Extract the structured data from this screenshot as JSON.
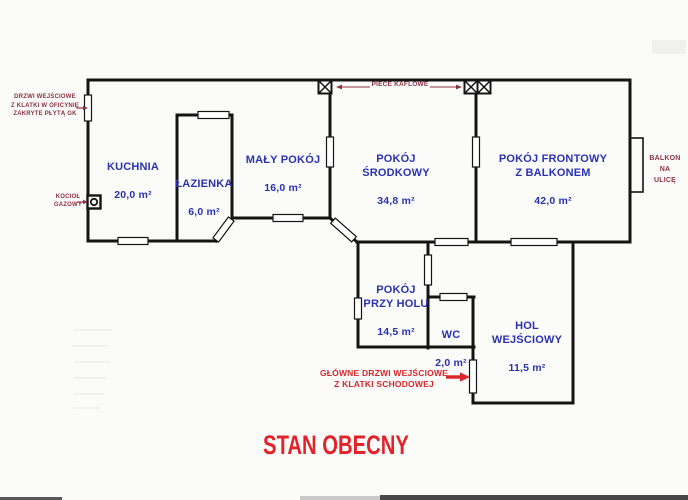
{
  "title": "STAN OBECNY",
  "colors": {
    "room_label_blue": "#2a33ae",
    "annotation_maroon": "#8b3342",
    "accent_red": "#d8272b",
    "title_red": "#e2242a",
    "wall_black": "#141414"
  },
  "plan": {
    "rooms": {
      "kuchnia": {
        "name": "KUCHNIA",
        "area": "20,0 m²"
      },
      "lazienka": {
        "name": "ŁAZIENKA",
        "area": "6,0 m²"
      },
      "maly_pokoj": {
        "name": "MAŁY POKÓJ",
        "area": "16,0 m²"
      },
      "pokoj_srodkowy": {
        "name": "POKÓJ\nŚRODKOWY",
        "area": "34,8 m²"
      },
      "pokoj_frontowy": {
        "name": "POKÓJ FRONTOWY\nZ BALKONEM",
        "area": "42,0 m²"
      },
      "pokoj_przy_holu": {
        "name": "POKÓJ\nPRZY HOLU",
        "area": "14,5 m²"
      },
      "wc": {
        "name": "WC",
        "area": "2,0 m²"
      },
      "hol_wejsciowy": {
        "name": "HOL\nWEJŚCIOWY",
        "area": "11,5 m²"
      }
    },
    "annotations": {
      "covered_door": "DRZWI WEJŚCIOWE\nZ KLATKI W OFICYNIE\nZAKRYTE PŁYTĄ GK",
      "gas_boiler": "KOCIOŁ\nGAZOWY",
      "tiled_stoves": "PIECE KAFLOWE",
      "balcony": "BALKON\nNA ULICĘ",
      "main_entrance": "GŁÓWNE DRZWI WEJŚCIOWE\nZ KLATKI SCHODOWEJ"
    }
  }
}
